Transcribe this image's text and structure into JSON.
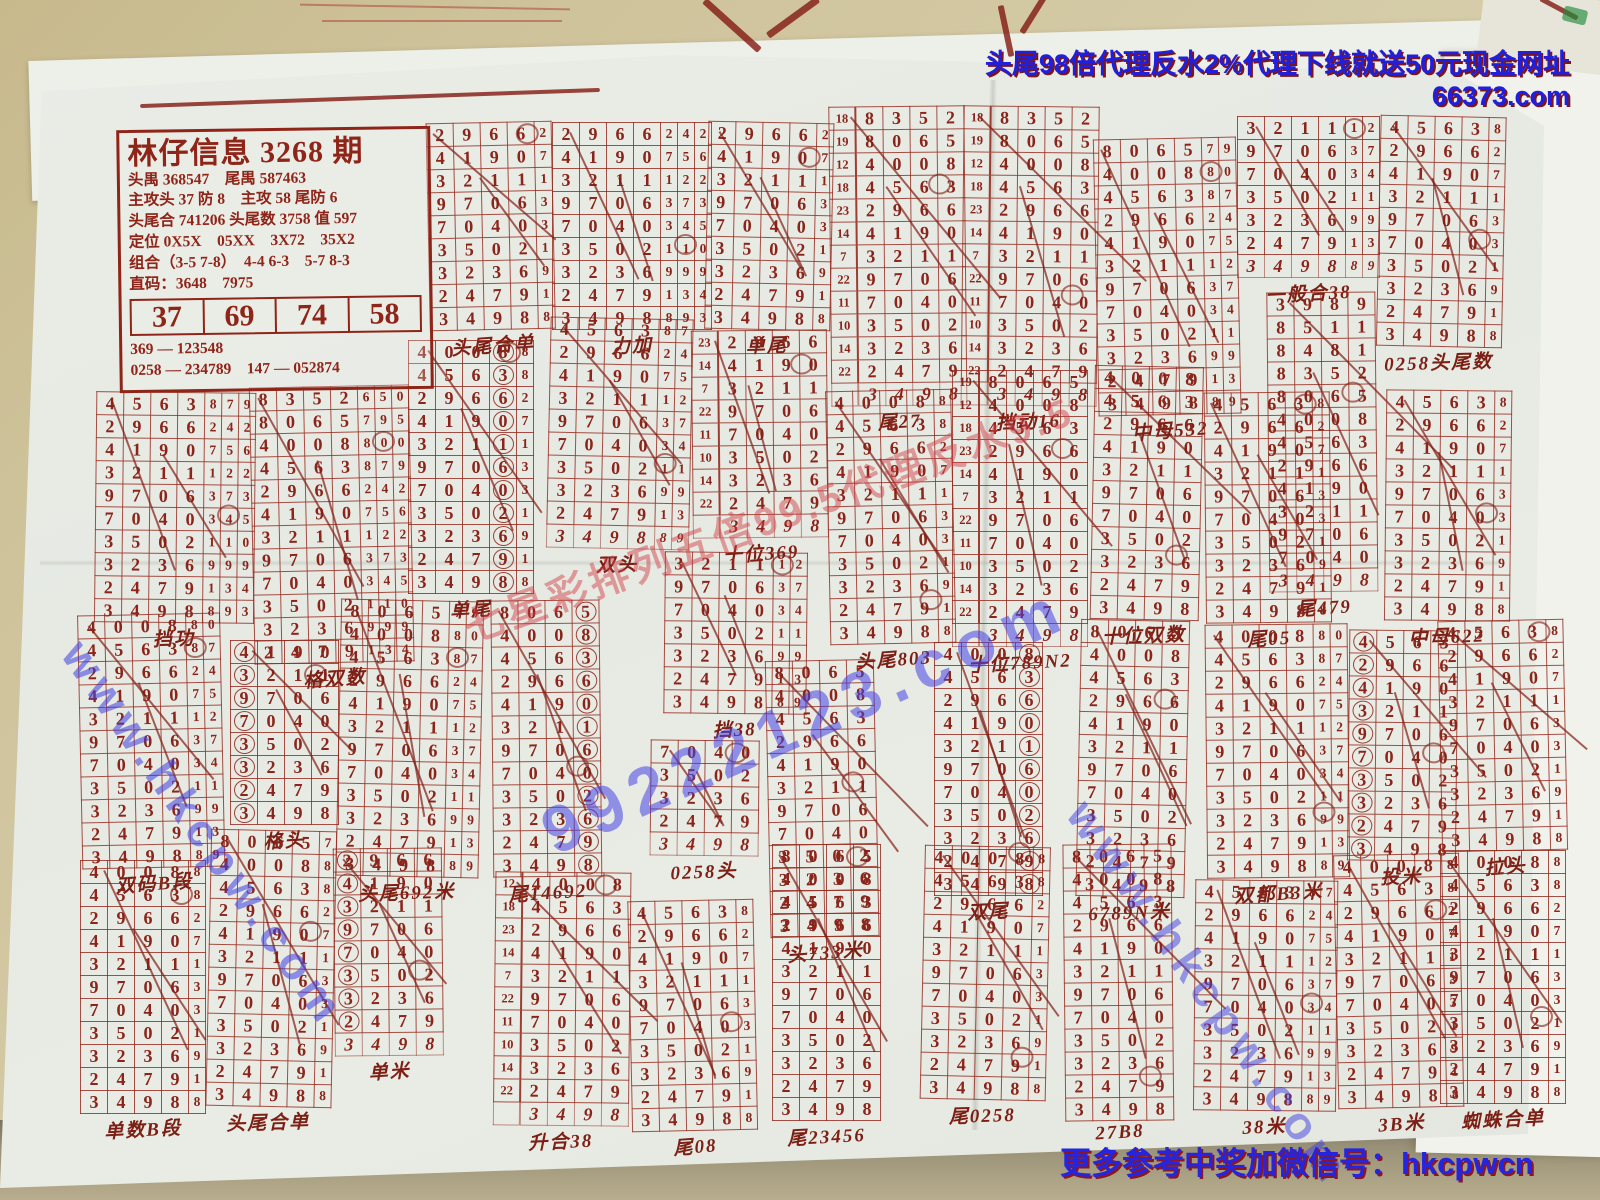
{
  "ads": {
    "top": "头尾98倍代理反水2%代理下线就送50元现金网址66373.com",
    "bottom": "更多参考中奖加微信号：hkcpwcn"
  },
  "watermarks": {
    "site": "www.hkcpw.com",
    "big": "99222123.com",
    "agent": "七星彩排列五倍99.5代理反水9.5"
  },
  "colors": {
    "ink": "#8b241a",
    "ad_blue": "#2020dc",
    "ad_shadow": "#7c1418",
    "paper": "#e8ebe4",
    "table": "#c9bc93"
  },
  "header": {
    "title": "林仔信息 3268 期",
    "rows": [
      "头禺 368547　尾禺 587463",
      "主攻头 37 防 8　主攻 58 尾防 6",
      "头尾合 741206 头尾数 3758 值 597",
      "定位 0X5X　05XX　3X72　35X2",
      "组合（3-5 7-8）　4-4 6-3　5-7 8-3",
      "直码：3648　7975"
    ],
    "big": [
      "37",
      "69",
      "74",
      "58"
    ],
    "foot1": "369 — 123548",
    "foot2": "0258 — 234789　147 — 052874"
  },
  "draws": [
    {
      "sum": 29,
      "d": "3989",
      "t": ""
    },
    {
      "sum": 15,
      "d": "8511",
      "t": ""
    },
    {
      "sum": 21,
      "d": "8481",
      "t": ""
    },
    {
      "sum": 18,
      "d": "8352",
      "t": "650"
    },
    {
      "sum": 19,
      "d": "8065",
      "t": "795"
    },
    {
      "sum": 12,
      "d": "4008",
      "t": "800"
    },
    {
      "sum": 18,
      "d": "4563",
      "t": "879"
    },
    {
      "sum": 23,
      "d": "2966",
      "t": "242"
    },
    {
      "sum": 14,
      "d": "4190",
      "t": "756"
    },
    {
      "sum": 7,
      "d": "3211",
      "t": "122"
    },
    {
      "sum": 22,
      "d": "9706",
      "t": "373"
    },
    {
      "sum": 11,
      "d": "7040",
      "t": "345"
    },
    {
      "sum": 10,
      "d": "3502",
      "t": "110"
    },
    {
      "sum": 14,
      "d": "3236",
      "t": "999"
    },
    {
      "sum": 22,
      "d": "2479",
      "t": "134"
    },
    {
      "sum": 24,
      "d": "3498",
      "t": "893"
    }
  ],
  "grids": [
    {
      "x": 428,
      "y": 122,
      "s": 7,
      "l": 9,
      "t": 1,
      "f": "头尾合单"
    },
    {
      "x": 552,
      "y": 122,
      "s": 7,
      "l": 9,
      "t": 3,
      "f": "力加"
    },
    {
      "x": 706,
      "y": 122,
      "s": 7,
      "l": 9,
      "t": 1,
      "f": "单尾"
    },
    {
      "x": 830,
      "y": 106,
      "s": 3,
      "l": 12,
      "i": 1,
      "h": 1,
      "f": "尾27"
    },
    {
      "x": 962,
      "y": 106,
      "s": 3,
      "l": 12,
      "i": 1,
      "h": 1,
      "f": "挡动16"
    },
    {
      "x": 1096,
      "y": 138,
      "s": 4,
      "l": 12,
      "t": 2,
      "f": "中母532"
    },
    {
      "x": 1237,
      "y": 116,
      "s": 9,
      "l": 6,
      "t": 2,
      "h": 1,
      "f": "一般合38"
    },
    {
      "x": 1378,
      "y": 116,
      "s": 6,
      "l": 10,
      "t": 1,
      "f": "0258头尾数"
    },
    {
      "x": 1268,
      "y": 292,
      "s": 0,
      "l": 12,
      "h": 1,
      "f": "尾479"
    },
    {
      "x": 95,
      "y": 392,
      "s": 6,
      "l": 10,
      "t": 3,
      "f": "挡功"
    },
    {
      "x": 252,
      "y": 386,
      "s": 3,
      "l": 12,
      "t": 3,
      "f": "格双数"
    },
    {
      "x": 408,
      "y": 340,
      "s": 5,
      "l": 11,
      "t": 1,
      "c": 3,
      "f": "单尾"
    },
    {
      "x": 548,
      "y": 318,
      "s": 6,
      "l": 9,
      "t": 2,
      "h": 1,
      "f": "双头"
    },
    {
      "x": 692,
      "y": 330,
      "s": 7,
      "l": 8,
      "i": 1,
      "h": 1,
      "f": "十位369"
    },
    {
      "x": 664,
      "y": 552,
      "s": 9,
      "l": 7,
      "t": 2,
      "f": "挡38"
    },
    {
      "x": 828,
      "y": 390,
      "s": 5,
      "l": 11,
      "t": 1,
      "f": "头尾803"
    },
    {
      "x": 952,
      "y": 370,
      "s": 4,
      "l": 11,
      "i": 1,
      "h": 1,
      "f": "十位789N2"
    },
    {
      "x": 1092,
      "y": 366,
      "s": 5,
      "l": 11,
      "f": "十位双数"
    },
    {
      "x": 1205,
      "y": 392,
      "s": 6,
      "l": 10,
      "t": 1,
      "f": "尾05"
    },
    {
      "x": 1385,
      "y": 390,
      "s": 6,
      "l": 10,
      "t": 1,
      "f": "中母622"
    },
    {
      "x": 80,
      "y": 614,
      "s": 5,
      "l": 11,
      "t": 2,
      "f": "双码B段"
    },
    {
      "x": 230,
      "y": 640,
      "s": 8,
      "l": 8,
      "c": 0,
      "f": "格头"
    },
    {
      "x": 338,
      "y": 600,
      "s": 4,
      "l": 12,
      "t": 2,
      "f": "头尾692米"
    },
    {
      "x": 492,
      "y": 600,
      "s": 4,
      "l": 12,
      "c": 3,
      "f": "尾14692"
    },
    {
      "x": 650,
      "y": 740,
      "s": 11,
      "l": 4,
      "h": 1,
      "f": "0258头"
    },
    {
      "x": 768,
      "y": 660,
      "s": 4,
      "l": 12,
      "f": "头733米"
    },
    {
      "x": 934,
      "y": 642,
      "s": 5,
      "l": 11,
      "c": 3,
      "f": "双尾"
    },
    {
      "x": 1078,
      "y": 620,
      "s": 4,
      "l": 12,
      "f": "6789N米"
    },
    {
      "x": 1206,
      "y": 624,
      "s": 5,
      "l": 11,
      "t": 2,
      "f": "双都B3米"
    },
    {
      "x": 1348,
      "y": 630,
      "s": 6,
      "l": 10,
      "c": 0,
      "f": "投米"
    },
    {
      "x": 1440,
      "y": 620,
      "s": 6,
      "l": 10,
      "t": 1,
      "f": "拉头"
    },
    {
      "x": 80,
      "y": 860,
      "s": 5,
      "l": 11,
      "t": 1,
      "f": "单数B段"
    },
    {
      "x": 208,
      "y": 830,
      "s": 4,
      "l": 12,
      "t": 1,
      "f": "头尾合单"
    },
    {
      "x": 334,
      "y": 848,
      "s": 7,
      "l": 8,
      "c": 0,
      "h": 1,
      "f": "单米"
    },
    {
      "x": 494,
      "y": 872,
      "s": 5,
      "l": 10,
      "i": 1,
      "h": 1,
      "f": "升合38"
    },
    {
      "x": 630,
      "y": 900,
      "s": 6,
      "l": 10,
      "t": 1,
      "f": "尾08"
    },
    {
      "x": 772,
      "y": 844,
      "s": 4,
      "l": 12,
      "f": "尾23456"
    },
    {
      "x": 922,
      "y": 846,
      "s": 5,
      "l": 11,
      "t": 1,
      "f": "尾0258"
    },
    {
      "x": 1064,
      "y": 844,
      "s": 4,
      "l": 12,
      "f": "27B8"
    },
    {
      "x": 1194,
      "y": 880,
      "s": 6,
      "l": 10,
      "t": 2,
      "f": "38米"
    },
    {
      "x": 1336,
      "y": 854,
      "s": 5,
      "l": 11,
      "t": 1,
      "f": "3B米"
    },
    {
      "x": 1440,
      "y": 850,
      "s": 5,
      "l": 11,
      "t": 1,
      "f": "蜘蛛合单"
    }
  ]
}
